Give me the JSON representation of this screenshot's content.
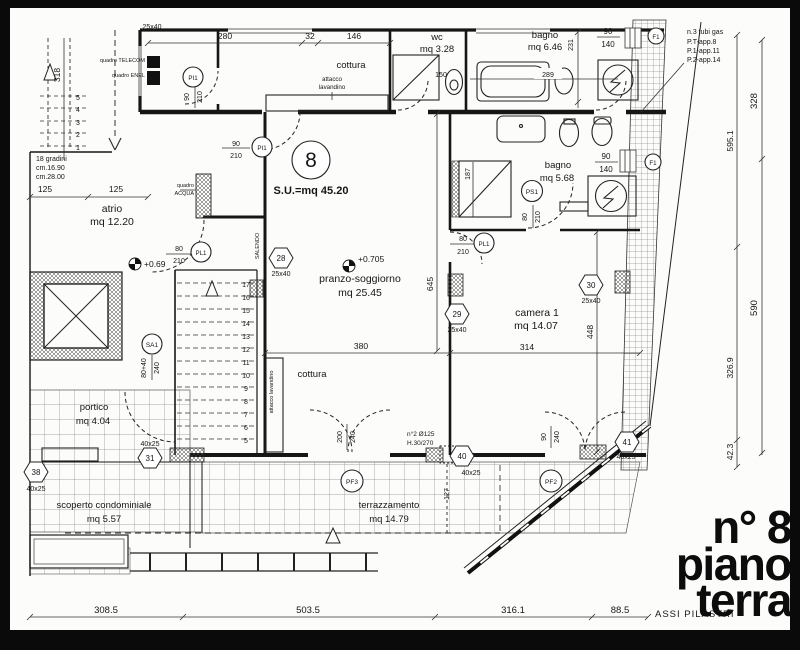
{
  "colors": {
    "ink": "#161616",
    "paper": "#fcfcfa",
    "frame": "#0a0a0a",
    "tile": "#8a8a8a"
  },
  "title": {
    "lines": [
      "n° 8",
      "piano",
      "terra"
    ]
  },
  "unit": {
    "number": "8",
    "surface": "S.U.=mq 45.20"
  },
  "rooms": {
    "atrio": {
      "label": "atrio",
      "area": "mq 12.20"
    },
    "wc": {
      "label": "wc",
      "area": "mq 3.28"
    },
    "bagno_top": {
      "label": "bagno",
      "area": "mq 6.46"
    },
    "bagno_mid": {
      "label": "bagno",
      "area": "mq 5.68"
    },
    "pranzo": {
      "label": "pranzo-soggiorno",
      "area": "mq 25.45"
    },
    "camera": {
      "label": "camera 1",
      "area": "mq 14.07"
    },
    "portico": {
      "label": "portico",
      "area": "mq 4.04"
    },
    "scoperto": {
      "label": "scoperto condominiale",
      "area": "mq 5.57"
    },
    "terrazzamento": {
      "label": "terrazzamento",
      "area": "mq 14.79"
    },
    "cottura_top": {
      "label": "cottura",
      "attacco": "attacco",
      "lavandino": "lavandino"
    },
    "cottura_mid": {
      "label": "cottura",
      "attacco": "attacco lavandino"
    }
  },
  "levels": {
    "atrio": "+0.69",
    "soggiorno": "+0.705",
    "terrazza": "127"
  },
  "doors": {
    "pi1_a": {
      "tag": "PI1",
      "w": "90",
      "h": "210"
    },
    "pi1_b": {
      "tag": "PI1",
      "w": "90",
      "h": "210"
    },
    "pl1_a": {
      "tag": "PL1",
      "w": "80",
      "h": "210"
    },
    "pl1_b": {
      "tag": "PL1",
      "w": "80",
      "h": "210"
    },
    "ps1": {
      "tag": "PS1",
      "w": "80",
      "h": "210"
    },
    "sa1": {
      "tag": "SA1",
      "w": "80+40",
      "h": "240"
    },
    "pf3": {
      "tag": "PF3"
    },
    "pf2": {
      "tag": "PF2"
    },
    "f1_a": {
      "tag": "F1"
    },
    "f1_b": {
      "tag": "F1"
    },
    "french": {
      "w": "200",
      "h": "240"
    },
    "camera_door": {
      "w": "90",
      "h": "240"
    },
    "win_top": {
      "w": "90",
      "h": "140"
    },
    "win_mid": {
      "w": "90",
      "h": "140"
    }
  },
  "pillars": {
    "p27": {
      "size": "25x40"
    },
    "p28": {
      "id": "28",
      "size": "25x40"
    },
    "p29": {
      "id": "29",
      "size": "25x40"
    },
    "p30": {
      "id": "30",
      "size": "25x40"
    },
    "p31": {
      "id": "31",
      "size": "40x25"
    },
    "p38": {
      "id": "38",
      "size": "40x25"
    },
    "p40": {
      "id": "40",
      "size": "40x25"
    },
    "p41": {
      "id": "41",
      "size": "40x25"
    }
  },
  "dims": {
    "top": [
      "280",
      "32",
      "146"
    ],
    "wc_inner": "150",
    "bagno_inner": "289",
    "bagno_depth": "231",
    "soggiorno_w": "380",
    "camera_w": "314",
    "soggiorno_h": "645",
    "camera_h": "448",
    "shower": "187",
    "stair_w1": "125",
    "stair_w2": "125",
    "stair_h": "318",
    "bottom": [
      "308.5",
      "503.5",
      "316.1",
      "88.5"
    ],
    "right_inner": [
      "595.1",
      "326.9",
      "42.3"
    ],
    "right_outer": [
      "328",
      "590"
    ]
  },
  "stairs": {
    "note1": "18 gradini",
    "note2": "cm.16.90",
    "note3": "cm.28.00",
    "salendo": "SALENDO",
    "numbers_main": [
      "17",
      "16",
      "15",
      "14",
      "13",
      "12",
      "11",
      "10",
      "9",
      "8",
      "7",
      "6",
      "5"
    ],
    "numbers_small": [
      "5",
      "4",
      "3",
      "2",
      "1"
    ]
  },
  "notes": {
    "gas": [
      "n.3 tubi gas",
      "P.T-app.8",
      "P.1-app.11",
      "P.2-app.14"
    ],
    "vent": [
      "n°2 Ø125",
      "H.30/270"
    ],
    "quadro_telecom": "quadro TELECOM",
    "quadro_enel": "quadro ENEL",
    "quadro_acqua_1": "quadro",
    "quadro_acqua_2": "ACQUA",
    "assi": "ASSI PILASTRI"
  }
}
